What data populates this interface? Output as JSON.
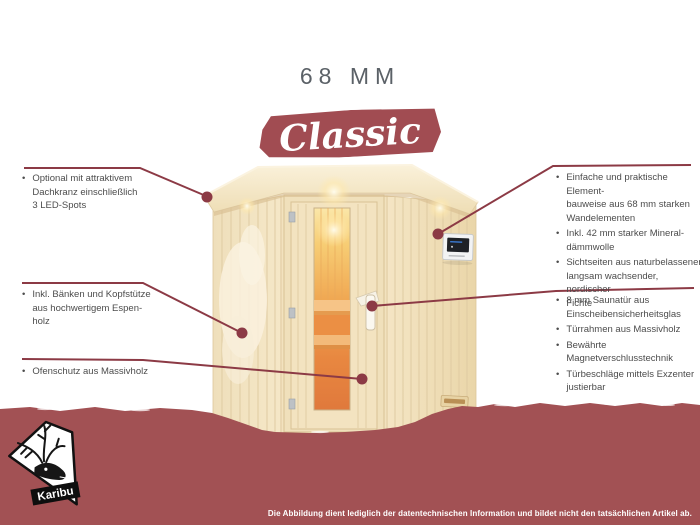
{
  "header": {
    "title": "68 MM",
    "product_name": "Classic"
  },
  "ui": {
    "bullet": "•"
  },
  "callouts": {
    "left": [
      {
        "bullets": [
          {
            "lines": [
              "Optional mit attraktivem",
              "Dachkranz einschließlich",
              "3 LED-Spots"
            ]
          }
        ]
      },
      {
        "bullets": [
          {
            "lines": [
              "Inkl. Bänken und Kopfstütze",
              "aus hochwertigem Espen-",
              "holz"
            ]
          }
        ]
      },
      {
        "bullets": [
          {
            "lines": [
              "Ofenschutz aus Massivholz"
            ]
          }
        ]
      }
    ],
    "right": [
      {
        "bullets": [
          {
            "lines": [
              "Einfache und praktische Element-",
              "bauweise aus 68 mm starken",
              "Wandelementen"
            ]
          },
          {
            "lines": [
              "Inkl. 42 mm starker Mineral-",
              "dämmwolle"
            ]
          },
          {
            "lines": [
              "Sichtseiten aus naturbelassener,",
              "langsam wachsender, nordischer",
              "Fichte"
            ]
          }
        ]
      },
      {
        "bullets": [
          {
            "lines": [
              "8 mm Saunatür aus",
              "Einscheibensicherheitsglas"
            ]
          },
          {
            "lines": [
              "Türrahmen aus Massivholz"
            ]
          },
          {
            "lines": [
              "Bewährte Magnetverschlusstechnik"
            ]
          },
          {
            "lines": [
              "Türbeschläge mittels Exzenter",
              "justierbar"
            ]
          }
        ]
      }
    ]
  },
  "logo": {
    "brand": "Karibu"
  },
  "footer": {
    "disclaimer": "Die Abbildung dient lediglich der datentechnischen Information und bildet nicht den tatsächlichen Artikel ab."
  },
  "colors": {
    "band_maroon": "#A25154",
    "banner_maroon": "#A14C52",
    "line_maroon": "#8C3A45",
    "title_gray": "#5B6167",
    "text_gray": "#4C4C4C",
    "wood_light": "#F3E4C2",
    "glass_glow_orange": "#E8873E"
  }
}
